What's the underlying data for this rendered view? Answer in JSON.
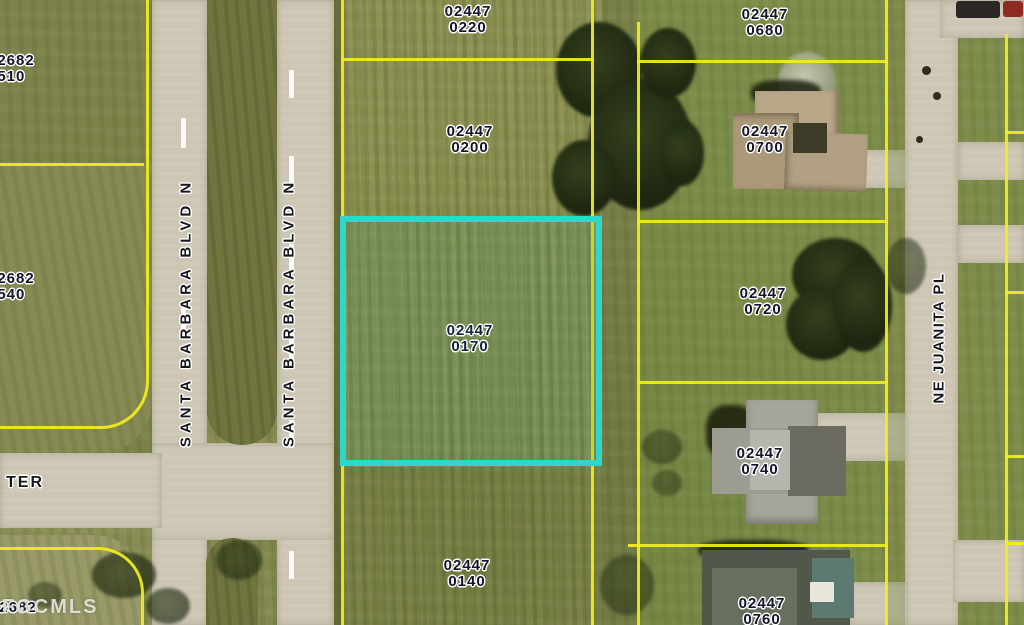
{
  "map": {
    "description": "Aerial parcel map with highlighted lot",
    "highlighted_parcel": "02447 0170",
    "watermark": "FGCMLS"
  },
  "colors": {
    "parcel-line": "#f2ee1a",
    "highlight": "#2fd6ca",
    "road": "#cdc6b4",
    "grass": "#8a8e55",
    "label-ink": "#14142a"
  },
  "streets": {
    "santa_barbara_1": "SANTA BARBARA BLVD N",
    "santa_barbara_2": "SANTA BARBARA BLVD N",
    "ne_juanita": "NE JUANITA PL",
    "ter": "TER"
  },
  "parcels": {
    "p0510": {
      "line1": "02682",
      "line2": "0510"
    },
    "p0540": {
      "line1": "02682",
      "line2": "0540"
    },
    "p0220": {
      "line1": "02447",
      "line2": "0220"
    },
    "p0200": {
      "line1": "02447",
      "line2": "0200"
    },
    "p0680": {
      "line1": "02447",
      "line2": "0680"
    },
    "p0700": {
      "line1": "02447",
      "line2": "0700"
    },
    "p0170": {
      "line1": "02447",
      "line2": "0170"
    },
    "p0720": {
      "line1": "02447",
      "line2": "0720"
    },
    "p0740": {
      "line1": "02447",
      "line2": "0740"
    },
    "p0140": {
      "line1": "02447",
      "line2": "0140"
    },
    "p0760": {
      "line1": "02447",
      "line2": "0760"
    },
    "p_bl": {
      "line1": "02682",
      "line2": ""
    }
  }
}
